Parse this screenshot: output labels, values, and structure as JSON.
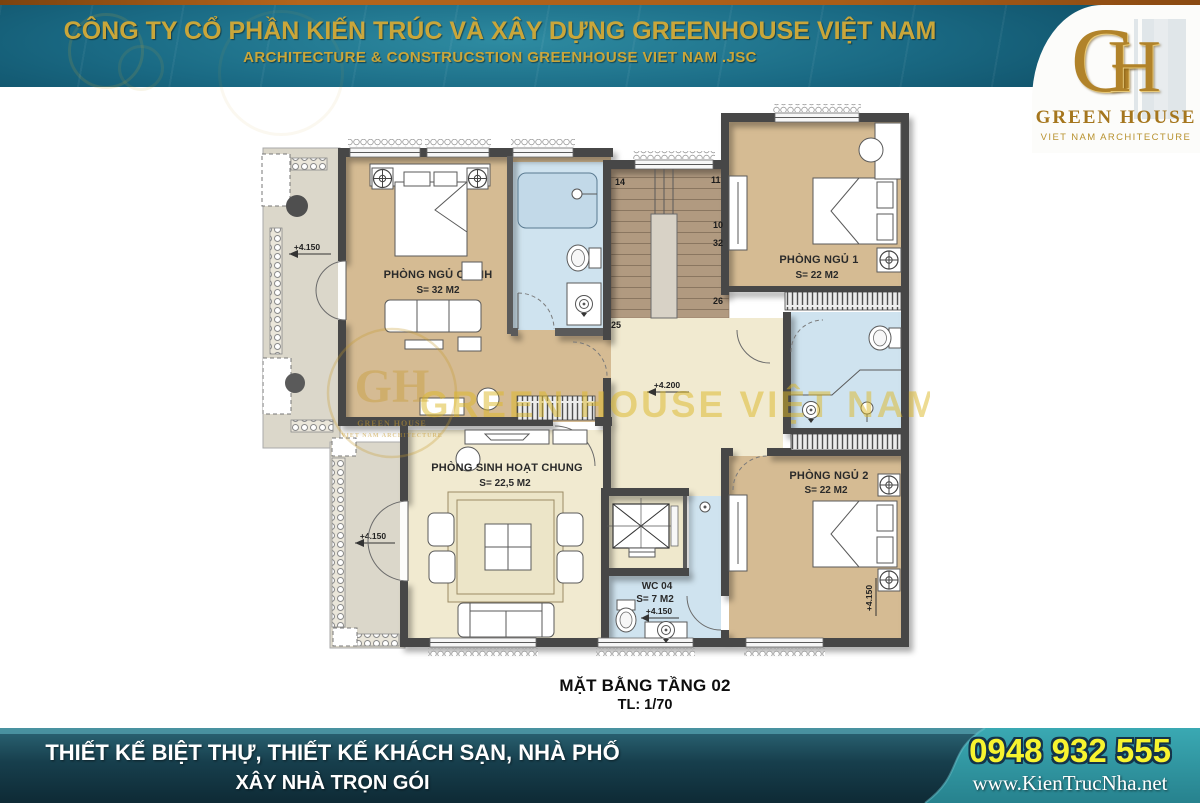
{
  "header": {
    "title": "CÔNG TY CỔ PHẦN KIẾN TRÚC VÀ XÂY DỰNG GREENHOUSE VIỆT NAM",
    "subtitle": "ARCHITECTURE & CONSTRUCSTION GREENHOUSE VIET NAM .JSC",
    "logo": {
      "monogram_g": "G",
      "monogram_h": "H",
      "name": "GREEN HOUSE",
      "tagline": "VIET NAM ARCHITECTURE"
    }
  },
  "plan": {
    "caption_title": "MẶT BẰNG TẦNG 02",
    "caption_scale": "TL: 1/70",
    "watermark": {
      "text": "GREEN HOUSE VIỆT NAM",
      "monogram": "GH",
      "name": "GREEN HOUSE",
      "tagline": "VIET NAM ARCHITECTURE"
    },
    "rooms": {
      "master_bedroom": {
        "name": "PHÒNG NGỦ CHÍNH",
        "area": "S= 32 M2"
      },
      "bedroom1": {
        "name": "PHÒNG NGỦ 1",
        "area": "S= 22 M2"
      },
      "bedroom2": {
        "name": "PHÒNG NGỦ 2",
        "area": "S= 22 M2"
      },
      "living_room": {
        "name": "PHÒNG SINH HOẠT CHUNG",
        "area": "S= 22,5 M2"
      },
      "wc": {
        "name": "WC 04",
        "area": "S= 7 M2"
      }
    },
    "elevations": {
      "balcony_upper": "+4.150",
      "balcony_lower": "+4.150",
      "hall": "+4.200",
      "wc": "+4.150",
      "bedroom2_wall": "+4.150"
    },
    "stairs": {
      "n14": "14",
      "n11": "11",
      "n10": "10",
      "n32": "32",
      "n26": "26",
      "n25": "25"
    }
  },
  "footer": {
    "line1": "THIẾT KẾ BIỆT THỰ, THIẾT KẾ KHÁCH SẠN, NHÀ PHỐ",
    "line2": "XÂY NHÀ TRỌN GÓI",
    "phone": "0948 932 555",
    "website": "www.KienTrucNha.net"
  },
  "colors": {
    "accent_gold": "#c9a63a",
    "band_teal": "#17637c",
    "phone_yellow": "#f7f32f",
    "floor_tan": "#d5bb93",
    "floor_cream": "#f1ead0",
    "bath_blue": "#cfe3ef",
    "stair_taupe": "#b19a80",
    "wall_dark": "#474747"
  }
}
